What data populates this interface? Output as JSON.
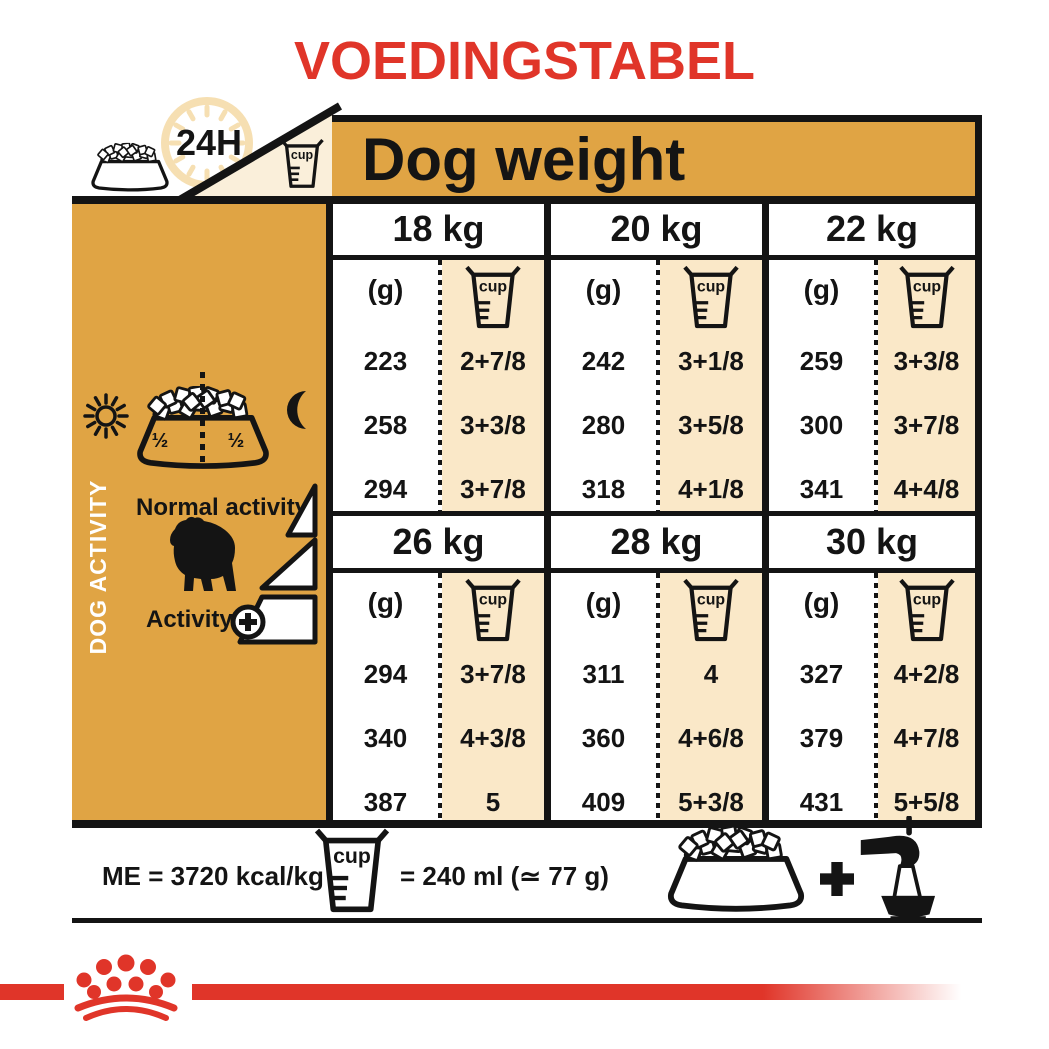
{
  "title": "VOEDINGSTABEL",
  "header": {
    "hours_badge": "24H",
    "dog_weight_label": "Dog weight"
  },
  "sidebar": {
    "dog_activity_label": "DOG ACTIVITY",
    "normal_activity_label": "Normal activity",
    "activity_label": "Activity",
    "bowl_half_left": "½",
    "bowl_half_right": "½"
  },
  "table": {
    "grams_unit": "(g)",
    "cup_unit": "cup"
  },
  "chart_data": {
    "type": "table",
    "title": "VOEDINGSTABEL",
    "column_group_header": "Dog weight",
    "row_axis": "dog activity, increasing from normal activity to activity +",
    "row_labels": [
      "normal activity",
      "medium activity",
      "activity +"
    ],
    "units": {
      "grams": "(g)",
      "cups": "cup",
      "cup_equivalence": "= 240 ml (≃ 77 g)",
      "energy_density": "ME = 3720 kcal/kg"
    },
    "groups": [
      {
        "weight": "18 kg",
        "rows": [
          {
            "g": "223",
            "cup": "2+7/8"
          },
          {
            "g": "258",
            "cup": "3+3/8"
          },
          {
            "g": "294",
            "cup": "3+7/8"
          }
        ]
      },
      {
        "weight": "20 kg",
        "rows": [
          {
            "g": "242",
            "cup": "3+1/8"
          },
          {
            "g": "280",
            "cup": "3+5/8"
          },
          {
            "g": "318",
            "cup": "4+1/8"
          }
        ]
      },
      {
        "weight": "22 kg",
        "rows": [
          {
            "g": "259",
            "cup": "3+3/8"
          },
          {
            "g": "300",
            "cup": "3+7/8"
          },
          {
            "g": "341",
            "cup": "4+4/8"
          }
        ]
      },
      {
        "weight": "26 kg",
        "rows": [
          {
            "g": "294",
            "cup": "3+7/8"
          },
          {
            "g": "340",
            "cup": "4+3/8"
          },
          {
            "g": "387",
            "cup": "5"
          }
        ]
      },
      {
        "weight": "28 kg",
        "rows": [
          {
            "g": "311",
            "cup": "4"
          },
          {
            "g": "360",
            "cup": "4+6/8"
          },
          {
            "g": "409",
            "cup": "5+3/8"
          }
        ]
      },
      {
        "weight": "30 kg",
        "rows": [
          {
            "g": "327",
            "cup": "4+2/8"
          },
          {
            "g": "379",
            "cup": "4+7/8"
          },
          {
            "g": "431",
            "cup": "5+5/8"
          }
        ]
      }
    ]
  },
  "footer": {
    "energy_label": "ME = 3720 kcal/kg",
    "cup_equiv_label": "= 240 ml (≃ 77 g)",
    "plus": "+"
  },
  "colors": {
    "brand_red": "#E03529",
    "panel_orange": "#E0A444",
    "cup_column_cream": "#FAE8C8",
    "wedge_cream": "#FAEFDA",
    "clock_pale": "#F6DFB2",
    "ink_black": "#141414"
  }
}
